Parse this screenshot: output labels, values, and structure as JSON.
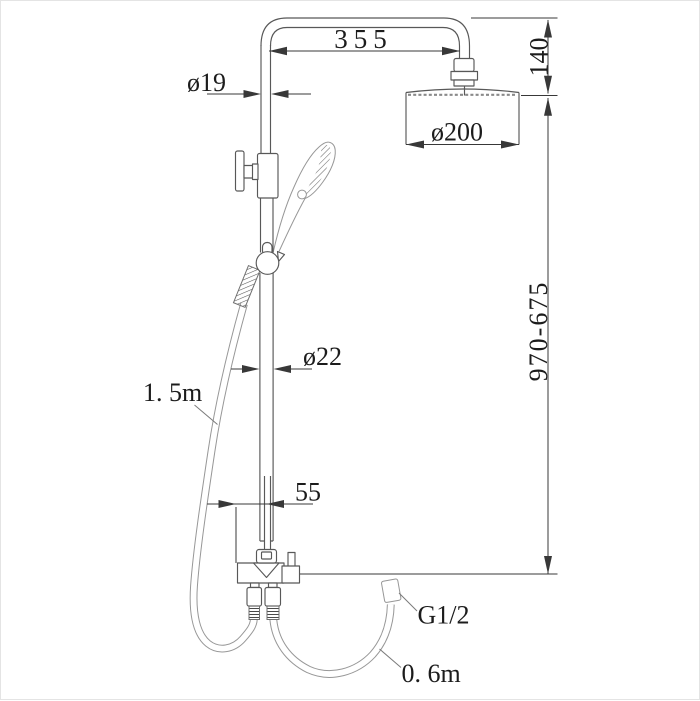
{
  "colors": {
    "line": "#585858",
    "soft_line": "#979797",
    "dimension_line": "#383838",
    "text": "#1c1c1c",
    "background": "#ffffff"
  },
  "labels": {
    "top_arm_width": "355",
    "head_drop_height": "140",
    "upper_pipe_diameter": "ø19",
    "head_diameter": "ø200",
    "column_height_range": "970-675",
    "lower_pipe_diameter": "ø22",
    "hand_shower_hose_length": "1. 5m",
    "pipe_to_mixer_offset": "55",
    "connection_thread_size": "G1/2",
    "outlet_hose_length": "0. 6m"
  }
}
